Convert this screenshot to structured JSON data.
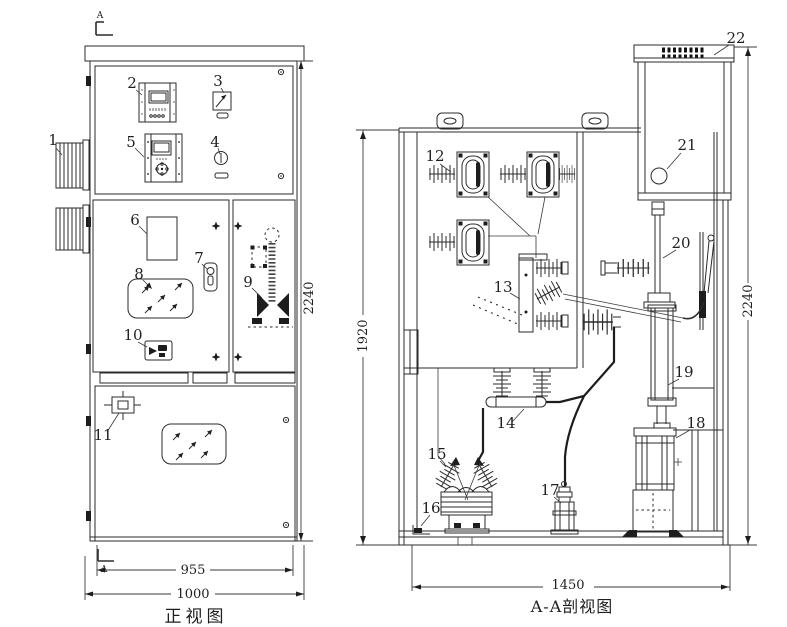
{
  "drawing": {
    "front_view": {
      "caption": "正视图",
      "section_letter": "A",
      "dim_height": "2240",
      "dim_inner_width": "955",
      "dim_width": "1000"
    },
    "section_view": {
      "caption": "A-A剖视图",
      "dim_inner_height": "1920",
      "dim_height": "2240",
      "dim_depth": "1450"
    },
    "parts": {
      "1": "1",
      "2": "2",
      "3": "3",
      "4": "4",
      "5": "5",
      "6": "6",
      "7": "7",
      "8": "8",
      "9": "9",
      "10": "10",
      "11": "11",
      "12": "12",
      "13": "13",
      "14": "14",
      "15": "15",
      "16": "16",
      "17": "17",
      "18": "18",
      "19": "19",
      "20": "20",
      "21": "21",
      "22": "22"
    }
  }
}
